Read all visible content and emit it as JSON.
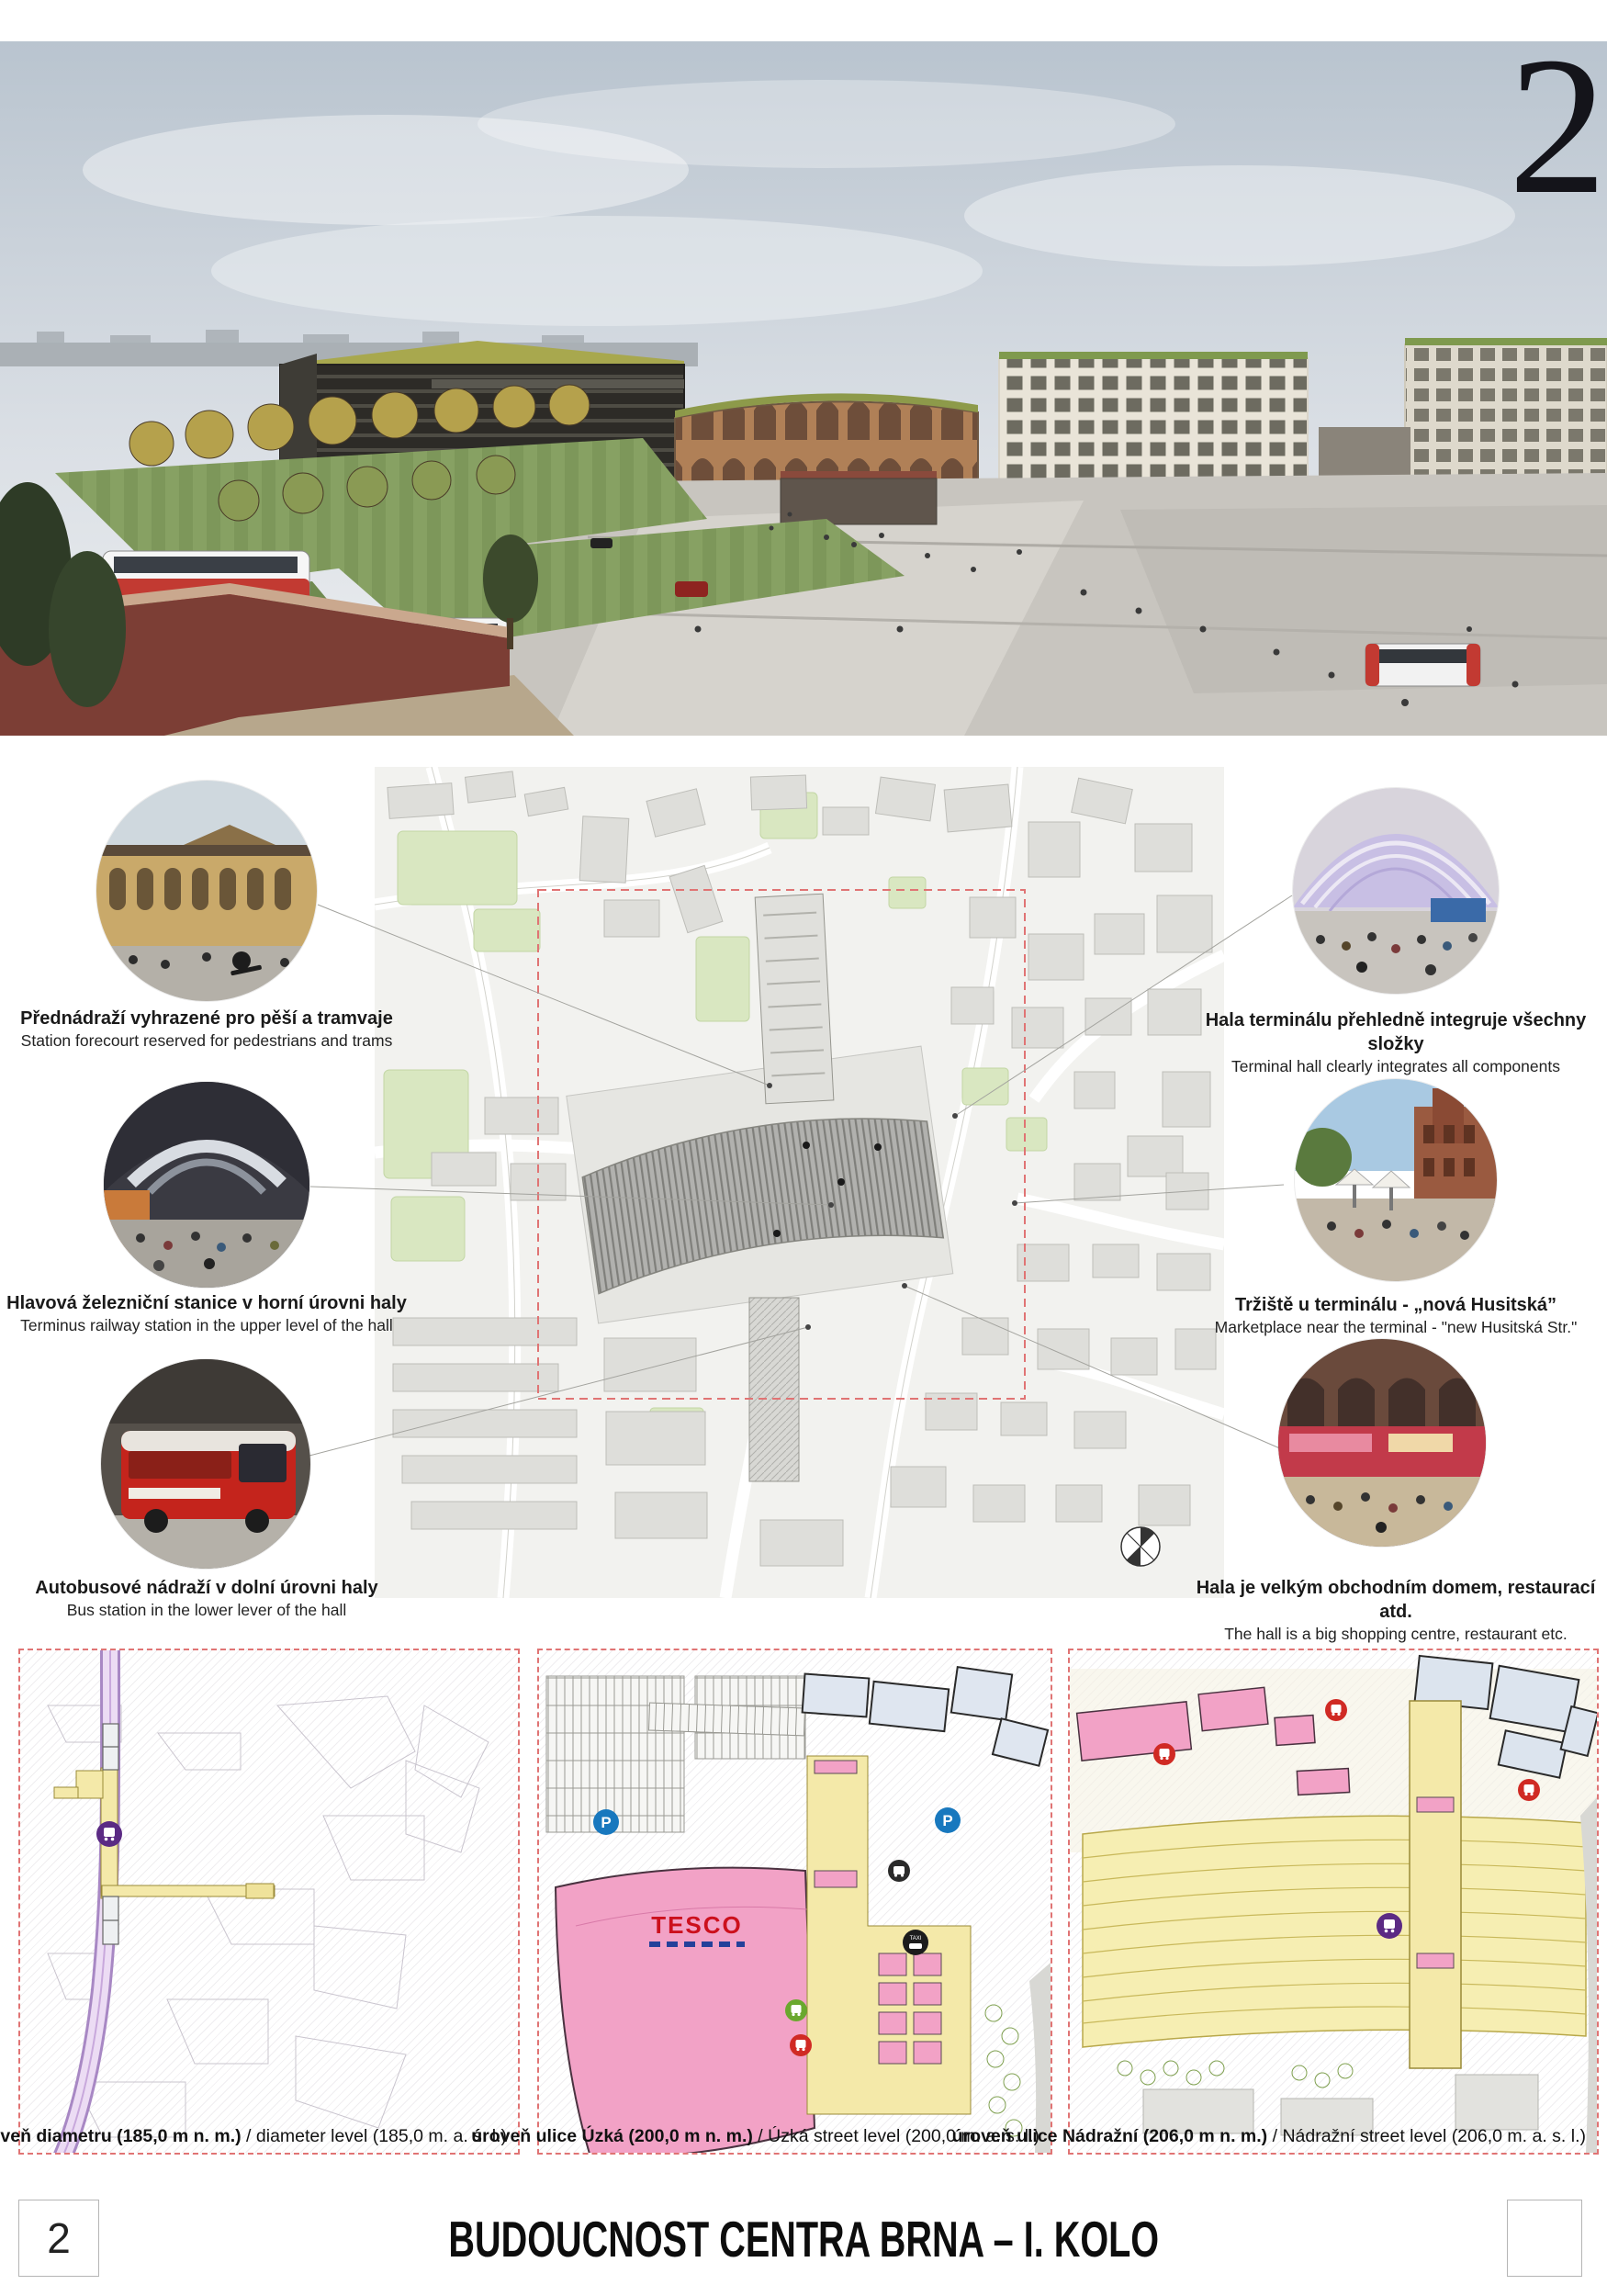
{
  "board": {
    "corner_number": "2",
    "footer": {
      "page_number": "2",
      "title": "BUDOUCNOST CENTRA BRNA – I. KOLO"
    }
  },
  "annotations": {
    "left": [
      {
        "cz": "Přednádraží vyhrazené pro pěší a tramvaje",
        "en": "Station forecourt reserved for pedestrians and trams"
      },
      {
        "cz": "Hlavová železniční stanice v horní úrovni haly",
        "en": "Terminus railway station in the upper level of the hall"
      },
      {
        "cz": "Autobusové nádraží v dolní úrovni haly",
        "en": "Bus station in the lower lever of the hall"
      }
    ],
    "right": [
      {
        "cz": "Hala terminálu přehledně integruje všechny složky",
        "en": "Terminal hall clearly integrates all components"
      },
      {
        "cz": "Tržiště u terminálu - „nová Husitská”",
        "en": "Marketplace near the terminal - \"new Husitská Str.\""
      },
      {
        "cz": "Hala je velkým obchodním domem, restaurací atd.",
        "en": "The hall is a big shopping centre, restaurant etc."
      }
    ]
  },
  "plans": [
    {
      "cz": "úroveň diametru (185,0 m n. m.)",
      "en": " / diameter level (185,0 m. a. s. l.)"
    },
    {
      "cz": "úroveň ulice Úzká (200,0 m n. m.)",
      "en": " / Úzká street level (200,0 m. a. s. l.)"
    },
    {
      "cz": "úroveň ulice Nádražní (206,0 m n. m.)",
      "en": " / Nádražní street level (206,0 m. a. s. l.)"
    }
  ],
  "map_labels": {
    "tesco": "TESCO",
    "taxi": "TAXI",
    "parking": "P"
  },
  "colors": {
    "accent_pink": "#f2a2c6",
    "accent_yellow": "#f4e9a9",
    "accent_purple": "#5b2a84",
    "parking_blue": "#1878be",
    "dashed_red": "#e07474",
    "tesco_red": "#cc101d",
    "tesco_blue": "#24409a"
  }
}
